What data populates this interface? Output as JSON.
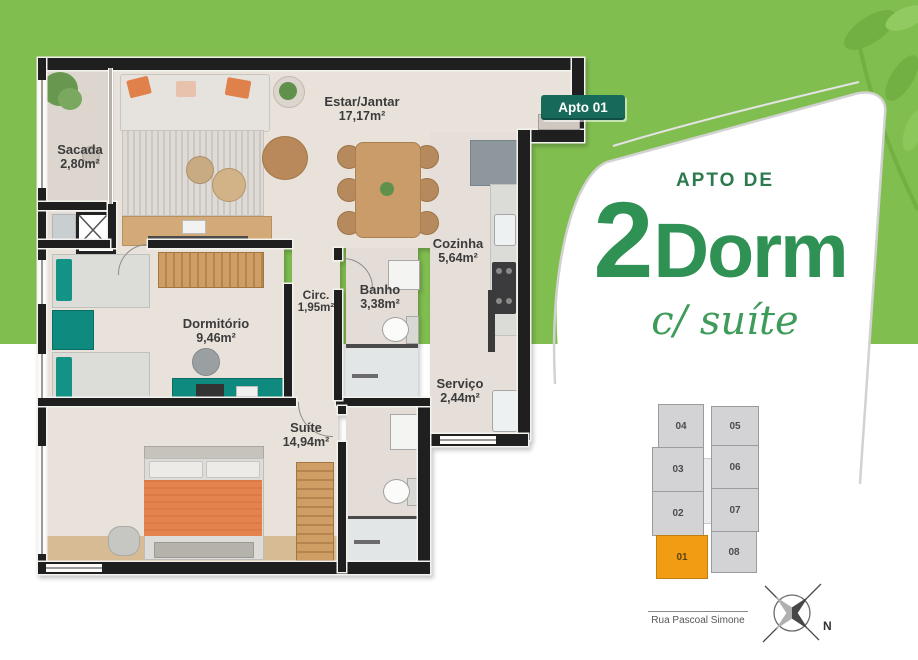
{
  "colors": {
    "background_green": "#81be50",
    "leaf_green": "#72b043",
    "leaf_green_light": "#90ca60",
    "text_green": "#2f9153",
    "kicker_green": "#2d7a4e",
    "script_green": "#3f9b5a",
    "badge_green": "#17695a",
    "highlight_orange": "#f29c13"
  },
  "apto_badge": {
    "label": "Apto 01"
  },
  "promo_panel": {
    "kicker": "APTO DE",
    "number": "2",
    "word": "Dorm",
    "script": "c/ suíte"
  },
  "floor_plan": {
    "rooms": {
      "sacada": {
        "name": "Sacada",
        "area": "2,80m²"
      },
      "estar": {
        "name": "Estar/Jantar",
        "area": "17,17m²"
      },
      "cozinha": {
        "name": "Cozinha",
        "area": "5,64m²"
      },
      "circ": {
        "name": "Circ.",
        "area": "1,95m²"
      },
      "banho": {
        "name": "Banho",
        "area": "3,38m²"
      },
      "dormitorio": {
        "name": "Dormitório",
        "area": "9,46m²"
      },
      "servico": {
        "name": "Serviço",
        "area": "2,44m²"
      },
      "suite": {
        "name": "Suíte",
        "area": "14,94m²"
      }
    }
  },
  "key_plan": {
    "units": [
      {
        "id": "04"
      },
      {
        "id": "05"
      },
      {
        "id": "03"
      },
      {
        "id": "06"
      },
      {
        "id": "02"
      },
      {
        "id": "07"
      },
      {
        "id": "01"
      },
      {
        "id": "08"
      }
    ],
    "highlighted_unit": "01"
  },
  "street": {
    "label": "Rua Pascoal Simone"
  },
  "compass": {
    "label": "N"
  }
}
